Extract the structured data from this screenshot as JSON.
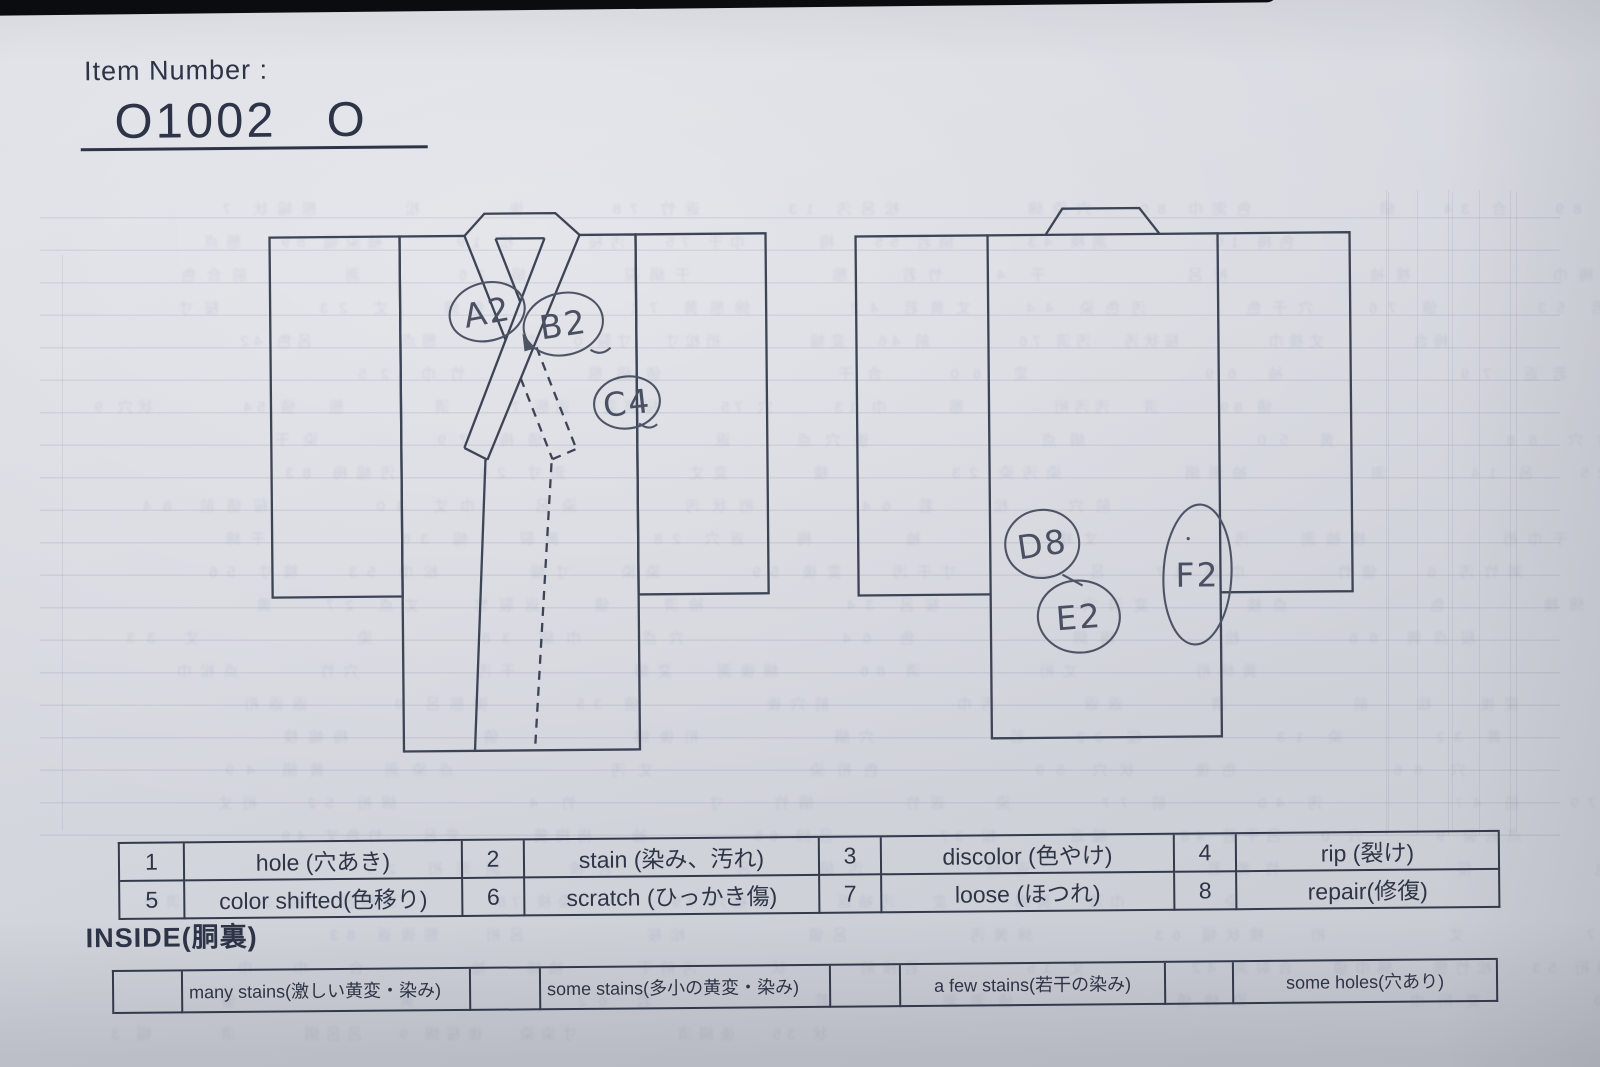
{
  "header": {
    "item_number_label": "Item Number :",
    "item_number_value": "O1002",
    "item_number_suffix": "O"
  },
  "diagram": {
    "annotations": {
      "front": [
        {
          "code": "A2"
        },
        {
          "code": "B2"
        },
        {
          "code": "C4"
        }
      ],
      "back": [
        {
          "code": "D8"
        },
        {
          "code": "E2"
        },
        {
          "code": "F2"
        }
      ]
    }
  },
  "legend": {
    "entries": [
      {
        "code": "1",
        "label": "hole (穴あき)"
      },
      {
        "code": "2",
        "label": "stain (染み、汚れ)"
      },
      {
        "code": "3",
        "label": "discolor (色やけ)"
      },
      {
        "code": "4",
        "label": "rip (裂け)"
      },
      {
        "code": "5",
        "label": "color shifted(色移り)"
      },
      {
        "code": "6",
        "label": "scratch (ひっかき傷)"
      },
      {
        "code": "7",
        "label": "loose (ほつれ)"
      },
      {
        "code": "8",
        "label": "repair(修復)"
      }
    ]
  },
  "inside": {
    "title": "INSIDE(胴裏)",
    "options": [
      {
        "label": "many stains(激しい黄変・染み)"
      },
      {
        "label": "some stains(多小の黄変・染み)"
      },
      {
        "label": "a few stains(若干の染み)"
      },
      {
        "label": "some holes(穴あり)"
      }
    ]
  },
  "colors": {
    "paper": "#d5d7de",
    "ink": "#333a4c",
    "pen": "#4a5062"
  }
}
